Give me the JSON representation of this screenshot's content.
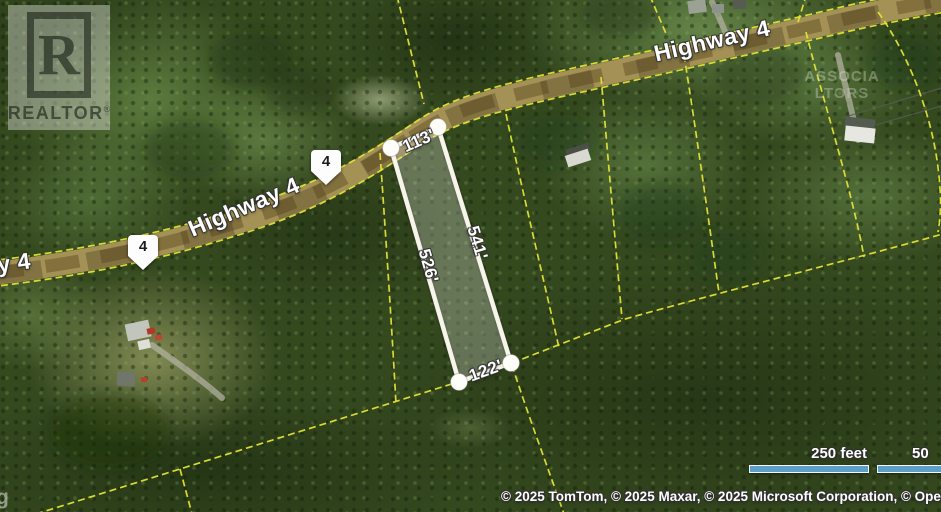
{
  "branding": {
    "logo_letter": "R",
    "realtor_logo_text": "REALTOR",
    "registered_mark": "®"
  },
  "map": {
    "road_labels": [
      {
        "text": "Highway 4"
      },
      {
        "text": "Highway 4"
      },
      {
        "text": "y 4"
      }
    ],
    "route_shields": [
      {
        "number": "4"
      },
      {
        "number": "4"
      }
    ],
    "parcel": {
      "dimensions": [
        {
          "label": "113'"
        },
        {
          "label": "541'"
        },
        {
          "label": "526'"
        },
        {
          "label": "122'"
        }
      ]
    },
    "watermark": {
      "line1": "ASSOCIA",
      "line2": "LTORS"
    },
    "corner_fragment": "g"
  },
  "scale": {
    "primary_label": "250 feet",
    "secondary_label": "50"
  },
  "attribution": {
    "text": "© 2025 TomTom, © 2025 Maxar, © 2025 Microsoft Corporation, © OpenStreetMap",
    "terms_label": "Term"
  },
  "colors": {
    "cadastral_line": "#e3e335",
    "parcel_outline": "#f7f4ea",
    "parcel_fill": "rgba(255,255,255,0.25)",
    "road_fill": "#a39156",
    "scale_bar": "#5e9fc7",
    "label_text": "#ffffff",
    "shield_text": "#1c1c1c"
  }
}
